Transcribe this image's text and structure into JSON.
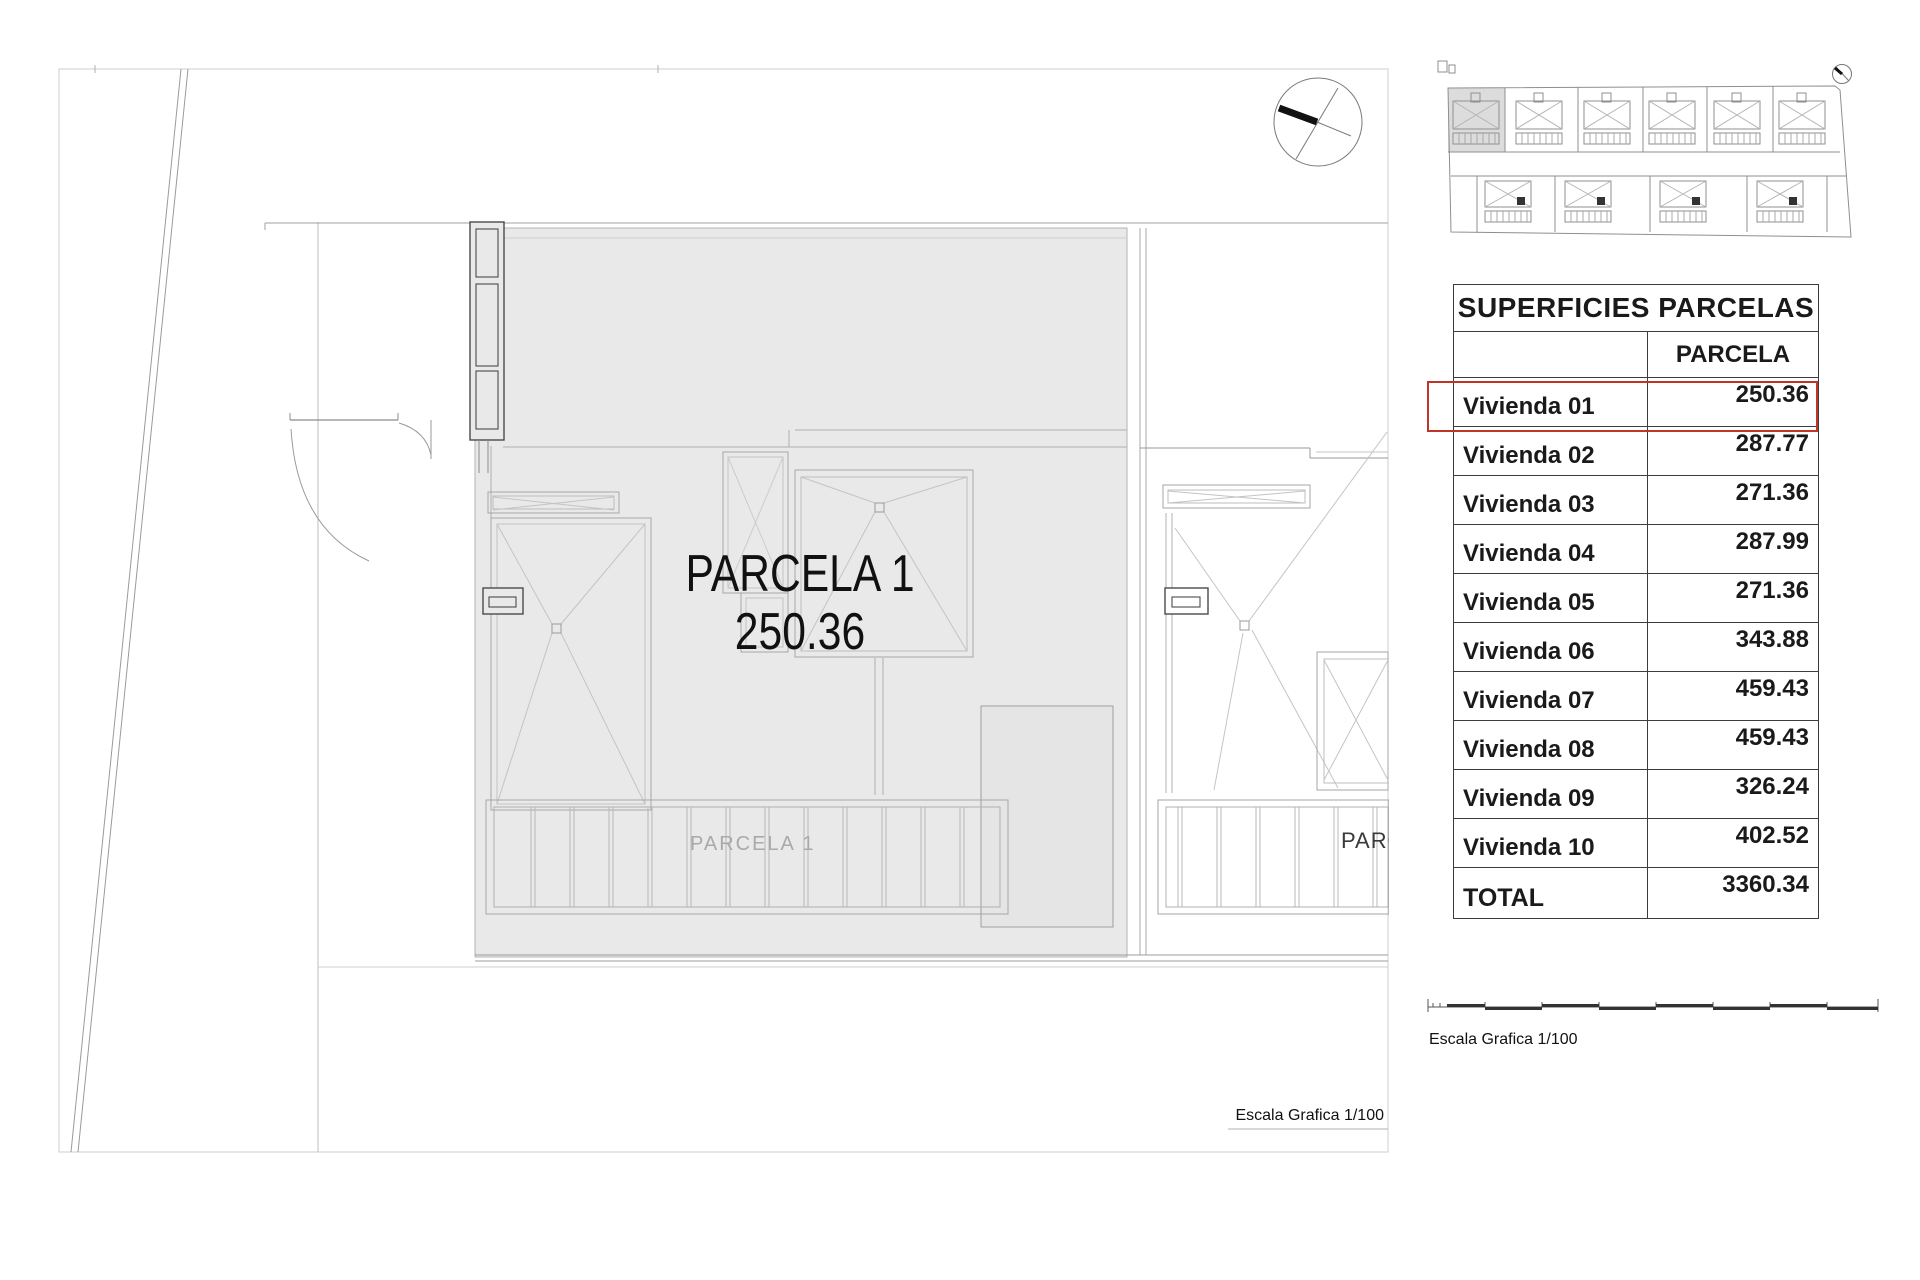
{
  "drawing": {
    "parcel_label": "PARCELA 1",
    "parcel_area": "250.36",
    "pergola_label": "PARCELA 1",
    "neighbor_label": "PARC",
    "scale_label": "Escala Grafica 1/100"
  },
  "minimap": {
    "scale_label": "Escala Grafica 1/100"
  },
  "table": {
    "title": "SUPERFICIES PARCELAS",
    "value_column_header": "PARCELA",
    "rows": [
      {
        "label": "Vivienda 01",
        "value": "250.36"
      },
      {
        "label": "Vivienda 02",
        "value": "287.77"
      },
      {
        "label": "Vivienda 03",
        "value": "271.36"
      },
      {
        "label": "Vivienda 04",
        "value": "287.99"
      },
      {
        "label": "Vivienda 05",
        "value": "271.36"
      },
      {
        "label": "Vivienda 06",
        "value": "343.88"
      },
      {
        "label": "Vivienda 07",
        "value": "459.43"
      },
      {
        "label": "Vivienda 08",
        "value": "459.43"
      },
      {
        "label": "Vivienda 09",
        "value": "326.24"
      },
      {
        "label": "Vivienda 10",
        "value": "402.52"
      }
    ],
    "total": {
      "label": "TOTAL",
      "value": "3360.34"
    },
    "highlighted_row": "Vivienda 01",
    "highlight_color": "#bf3527"
  },
  "colors": {
    "parcel_fill": "#e9e9e9",
    "patio_fill": "#e3e3e3",
    "minimap_highlight": "#dcdcdc",
    "highlight_red": "#bf3527"
  }
}
